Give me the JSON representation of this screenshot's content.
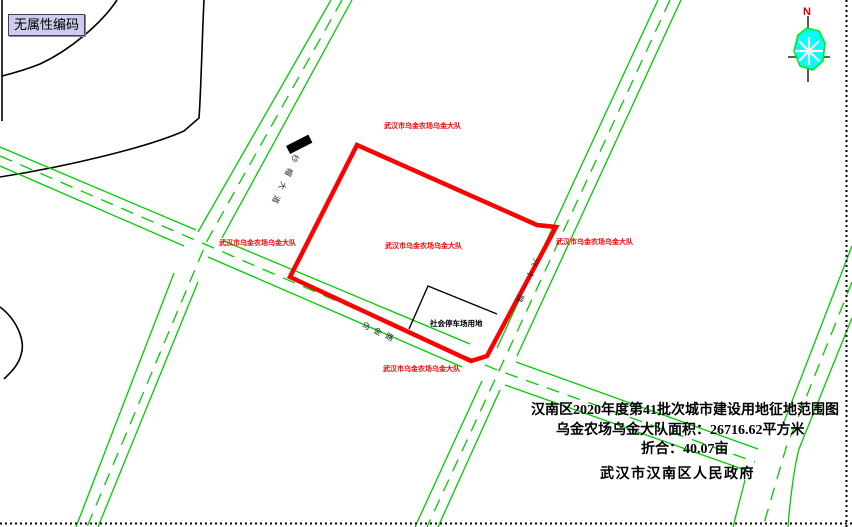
{
  "tooltip": {
    "label": "无属性编码"
  },
  "compass": {
    "north_label": "N"
  },
  "map": {
    "parcel_label": "武汉市乌金农场乌金大队",
    "parking_label": "社会停车场用地",
    "roads": {
      "left_road_name": "纱帽大道",
      "bottom_road_name": "乌金路",
      "right_road_name": "兴十一路"
    },
    "title_block": {
      "line1": "汉南区2020年度第41批次城市建设用地征地范围图",
      "line2": "乌金农场乌金大队面积：26716.62平方米",
      "line3": "折合：40.07亩",
      "line4": "武汉市汉南区人民政府"
    }
  },
  "colors": {
    "road_green": "#00cc00",
    "parcel_red": "#ff0000",
    "label_red": "#ff0000",
    "boundary_black": "#000000",
    "compass_cyan": "#00ffff",
    "compass_green": "#00ee00",
    "tooltip_bg": "#ccccec"
  }
}
